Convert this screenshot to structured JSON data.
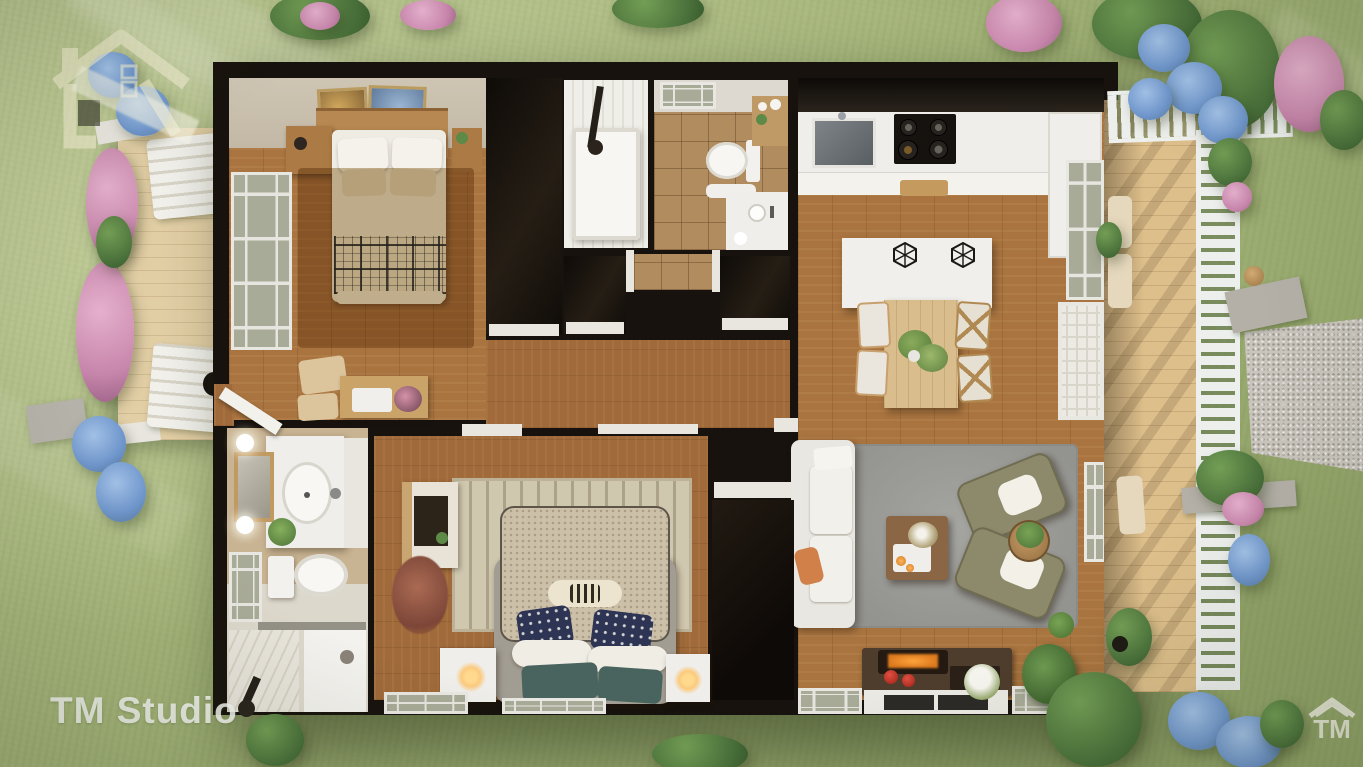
{
  "scene": {
    "type": "3d-floor-plan-render",
    "watermarks": {
      "studio_text": "TM Studio",
      "corner_text": "TM"
    },
    "palette": {
      "grass": "#a9bb7f",
      "wood_floor": "#a9743f",
      "deck_wood": "#ddbf8b",
      "wall_dark": "#17120d",
      "wall_beige": "#c9beac",
      "rug_gray": "#9c9c98",
      "rug_beige": "#c4b28e",
      "tile_tan": "#b18c5e",
      "furniture_white": "#efeeea",
      "pillow_navy": "#2e3554",
      "pillow_teal": "#49645e",
      "accent_orange": "#d08048",
      "gravel": "#c9c5bd",
      "hydrangea_blue": "#7097cd",
      "hydrangea_pink": "#c785ab"
    },
    "rooms": [
      "bedroom",
      "bathroom",
      "hallway-closets",
      "kitchen",
      "dining-area",
      "living-room",
      "master-bedroom",
      "ensuite-bathroom",
      "left-porch",
      "right-deck",
      "garden"
    ]
  }
}
